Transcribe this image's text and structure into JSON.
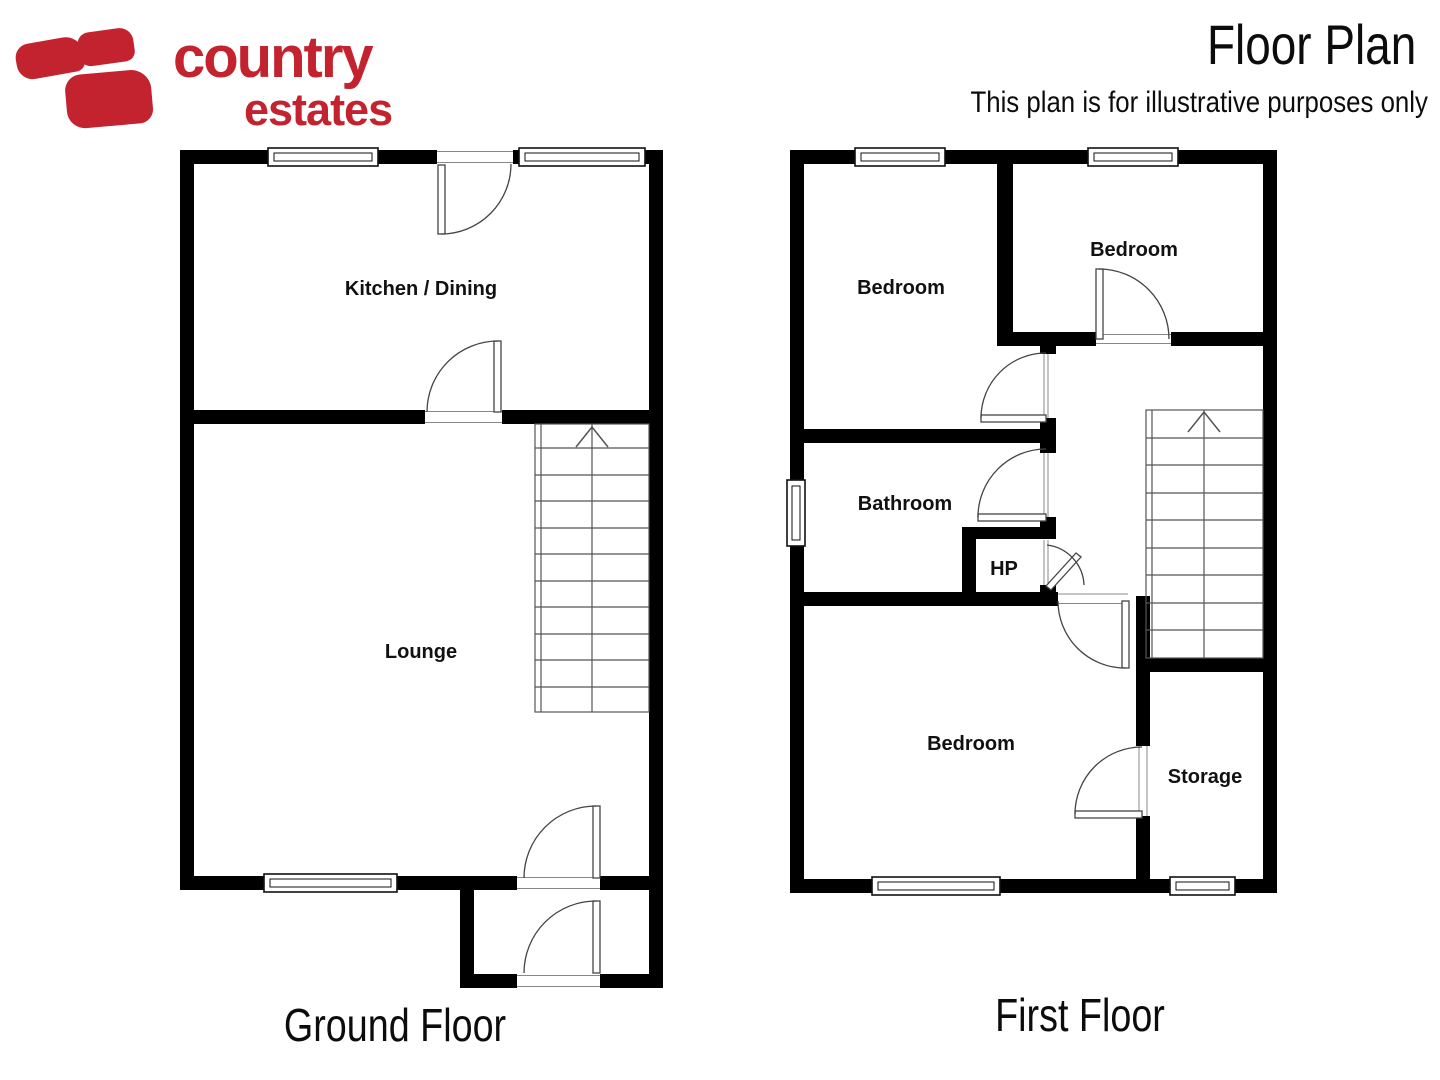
{
  "brand": {
    "word1": "country",
    "word2": "estates",
    "color": "#c2232f"
  },
  "header": {
    "title": "Floor Plan",
    "subtitle": "This plan is for illustrative purposes only"
  },
  "ground": {
    "label": "Ground Floor",
    "rooms": {
      "kitchen": "Kitchen / Dining",
      "lounge": "Lounge"
    }
  },
  "first": {
    "label": "First Floor",
    "rooms": {
      "bedroom_left": "Bedroom",
      "bedroom_right": "Bedroom",
      "bathroom": "Bathroom",
      "hp": "HP",
      "bedroom_bottom": "Bedroom",
      "storage": "Storage"
    }
  },
  "colors": {
    "wall": "#000000",
    "brand_red": "#c2232f",
    "line": "#555555"
  }
}
